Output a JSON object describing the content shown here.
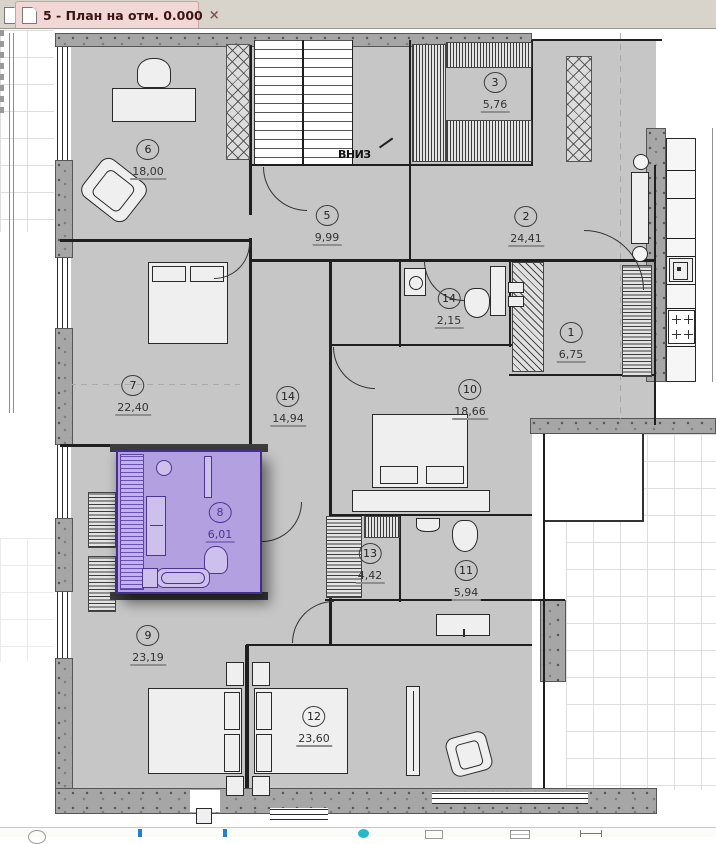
{
  "tab_bar": {
    "tab": {
      "title": "5 - План на отм. 0.000",
      "close": "×"
    }
  },
  "plan": {
    "stairs_label": "ВНИЗ",
    "rooms": [
      {
        "num": "6",
        "area": "18,00"
      },
      {
        "num": "3",
        "area": "5,76"
      },
      {
        "num": "5",
        "area": "9,99"
      },
      {
        "num": "2",
        "area": "24,41"
      },
      {
        "num": "14",
        "area": "2,15"
      },
      {
        "num": "1",
        "area": "6,75"
      },
      {
        "num": "7",
        "area": "22,40"
      },
      {
        "num": "14",
        "area": "14,94"
      },
      {
        "num": "10",
        "area": "18,66"
      },
      {
        "num": "8",
        "area": "6,01"
      },
      {
        "num": "13",
        "area": "4,42"
      },
      {
        "num": "11",
        "area": "5,94"
      },
      {
        "num": "9",
        "area": "23,19"
      },
      {
        "num": "12",
        "area": "23,60"
      }
    ],
    "selected_room": {
      "num": "8",
      "area": "6,01"
    }
  },
  "colors": {
    "tab_active_bg": "#f2d7d7",
    "selection_fill": "#b3a0e0",
    "selection_border": "#432d8f",
    "floor_gray": "#c6c6c6"
  },
  "toolbar_icons": [
    "circle-tool",
    "caret",
    "caret",
    "ellipse-tool",
    "rect-tool",
    "layers-tool",
    "dimension-tool"
  ]
}
